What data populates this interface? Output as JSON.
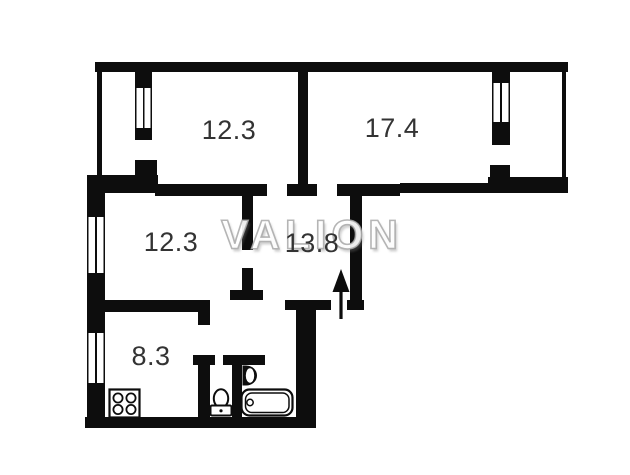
{
  "floorplan": {
    "watermark_text": "VALION",
    "rooms": [
      {
        "id": "room-top-left",
        "area": "12.3"
      },
      {
        "id": "room-top-right",
        "area": "17.4"
      },
      {
        "id": "room-middle",
        "area": "12.3"
      },
      {
        "id": "hallway",
        "area": "13.8"
      },
      {
        "id": "kitchen",
        "area": "8.3"
      }
    ],
    "fixtures": [
      "stove-icon",
      "toilet-icon",
      "sink-icon",
      "bathtub-icon",
      "entrance-arrow-icon"
    ],
    "colors": {
      "wall": "#0d0d0d",
      "room_label": "#333333",
      "watermark": "#a8a8a8",
      "background": "#ffffff"
    }
  }
}
